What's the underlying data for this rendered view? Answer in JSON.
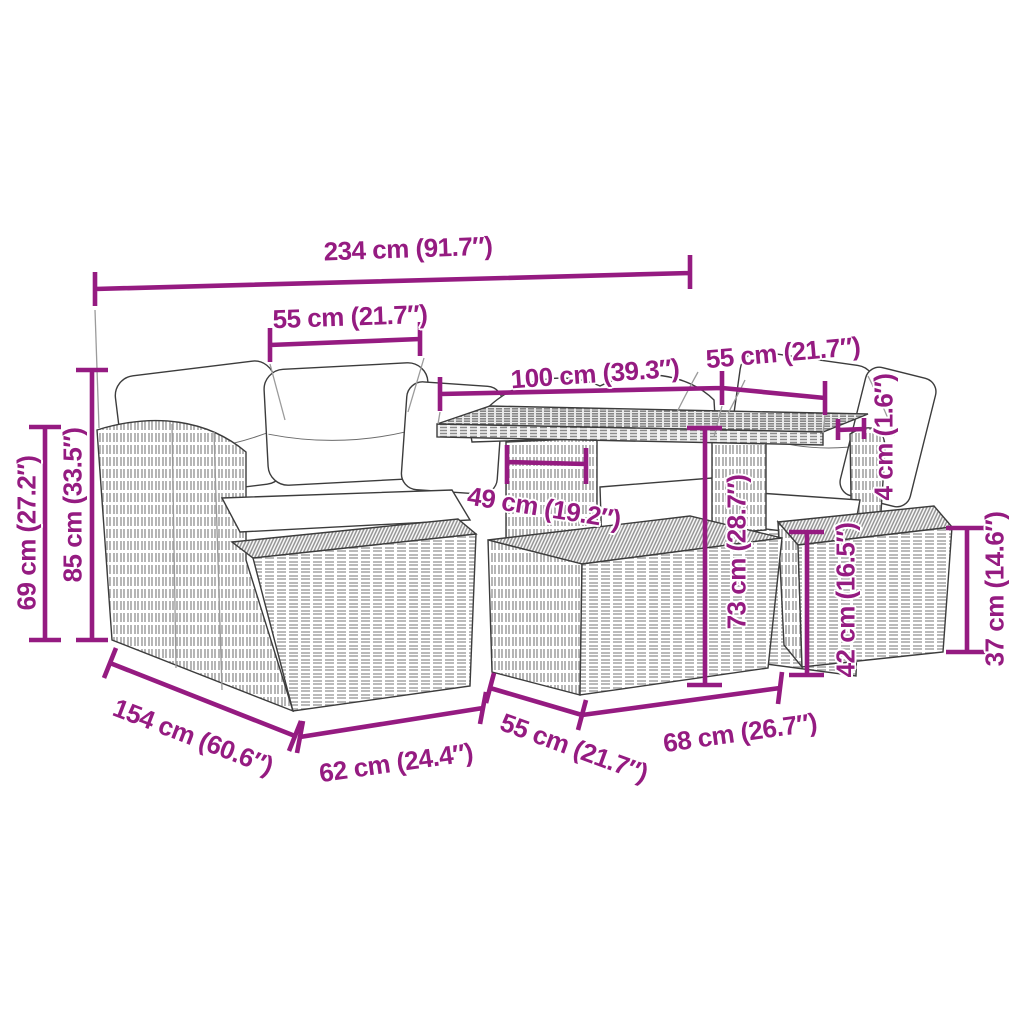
{
  "diagram": {
    "kind": "product-dimension-drawing",
    "product_sketch": "rattan garden lounge set with corner sofa, glass-top table, stools and cushions",
    "units": {
      "primary": "cm",
      "secondary": "inches"
    },
    "colors": {
      "accent": "#951B81",
      "sketch_outline": "#3c3c3c",
      "weave_light": "#a3a3a3",
      "weave_dark": "#7d7d7d",
      "background": "#ffffff"
    },
    "dims": {
      "total_width": "234 cm (91.7″)",
      "seat_width_left": "55 cm (21.7″)",
      "table_length": "100 cm (39.3″)",
      "seat_width_right": "55 cm (21.7″)",
      "back_height": "69 cm (27.2″)",
      "total_height": "85 cm (33.5″)",
      "leg_panel_width": "49 cm (19.2″)",
      "table_height": "73 cm (28.7″)",
      "tabletop_thickness": "4 cm (1.6″)",
      "stool_mid_height": "42 cm (16.5″)",
      "stool_right_height": "37 cm (14.6″)",
      "sofa_depth": "154 cm (60.6″)",
      "stool_front_width": "62 cm (24.4″)",
      "stool_front_depth": "55 cm (21.7″)",
      "table_front_width": "68 cm (26.7″)"
    }
  }
}
